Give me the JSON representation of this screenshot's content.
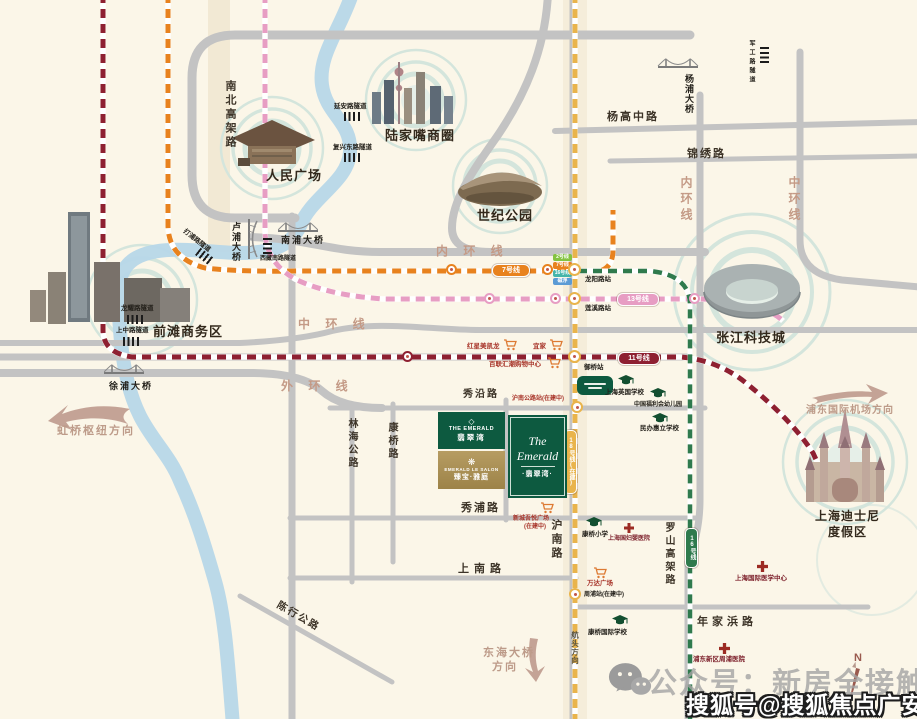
{
  "landmarks": {
    "peoples_square": "人民广场",
    "lujiazui": "陆家嘴商圈",
    "century_park": "世纪公园",
    "qiantan": "前滩商务区",
    "zhangjiang": "张江科技城",
    "disney_line1": "上海迪士尼",
    "disney_line2": "度假区"
  },
  "roads": {
    "nanbei_elevated": "南北高架路",
    "yanggao_mid": "杨高中路",
    "jinxiu": "锦绣路",
    "inner_ring_v": "内环线",
    "inner_ring_h": "内 环 线",
    "mid_ring_v": "中环线",
    "mid_ring_h": "中 环 线",
    "outer_ring": "外 环 线",
    "luoshan_elevated": "罗山高架路",
    "hunan_rd": "沪南路",
    "shangnan_rd": "上南路",
    "xiupu_rd": "秀浦路",
    "xiuyan_rd": "秀沿路",
    "linhai_hwy": "林海公路",
    "kangqiao_rd": "康桥路",
    "nianjiabang_rd": "年家浜路",
    "chenhang_hwy": "陈行公路"
  },
  "bridges": {
    "nanpu": "南浦大桥",
    "lupu": "卢浦大桥",
    "xupu": "徐浦大桥",
    "yangpu": "杨浦大桥"
  },
  "tunnels": {
    "yanan": "延安路隧道",
    "fuxing": "复兴东路隧道",
    "xizang": "西藏南路隧道",
    "dapu": "打浦路隧道",
    "longyao": "龙耀路隧道",
    "shangzhong": "上中路隧道",
    "jungong": "军工路隧道"
  },
  "metro": {
    "line7": "7号线",
    "line13": "13号线",
    "line11": "11号线",
    "line16": "16号线",
    "line18": "18号线(在建)",
    "interchange_chips": [
      "2号线",
      "7号线",
      "16号线",
      "磁浮"
    ]
  },
  "stations": {
    "longyang": "龙阳路站",
    "lianxi": "莲溪路站",
    "yuqiao": "御桥站",
    "hunan_hwy": "沪南公路站(在建中)",
    "zhoupu": "周浦站(在建中)"
  },
  "pois": {
    "hongxing": "红星美凯龙",
    "ikea": "宜家",
    "bailian": "百联汇潮购物中心",
    "wuyue_l1": "新城吾悦广场",
    "wuyue_l2": "(在建中)",
    "wanda": "万达广场",
    "british_school": "上海英国学校",
    "welfare_kindergarten": "中国福利会幼儿园",
    "huili_school": "民办惠立学校",
    "kangqiao_primary": "康桥小学",
    "intl_school": "康桥国际学校",
    "guofuying_hospital": "上海国妇婴医院",
    "intl_medical": "上海国际医学中心",
    "zhoupu_hospital": "浦东新区周浦医院"
  },
  "directions": {
    "hongqiao": "虹桥枢纽方向",
    "pudong_airport": "浦东国际机场方向",
    "donghai_l1": "东海大桥",
    "donghai_l2": "方向",
    "hangtou": "航头方向"
  },
  "project": {
    "logo1_en": "THE EMERALD",
    "logo1_cn": "翡翠湾",
    "logo2_en": "EMERALD LE SALON",
    "logo2_cn": "臻宝·雅庭",
    "logo3_en": "The Emerald",
    "logo3_cn": "·翡翠湾·"
  },
  "watermark": {
    "wechat_line": "公众号：新房全接触",
    "sohu_line": "搜狐号@搜狐焦点广安站",
    "compass_n": "N"
  },
  "colors": {
    "line7": "#e8821e",
    "line13": "#e79dc3",
    "line11": "#8e2031",
    "line16": "#2f7a4d",
    "line18": "#e9b44c",
    "line2": "#84c341",
    "maglev": "#5b9bd5",
    "ring_label": "#c49a86",
    "river": "#b7d7e8",
    "road": "#c3c3c3",
    "bg": "#fbf6e8",
    "green_logo": "#0d5a40",
    "gold_logo": "#a98f55"
  }
}
